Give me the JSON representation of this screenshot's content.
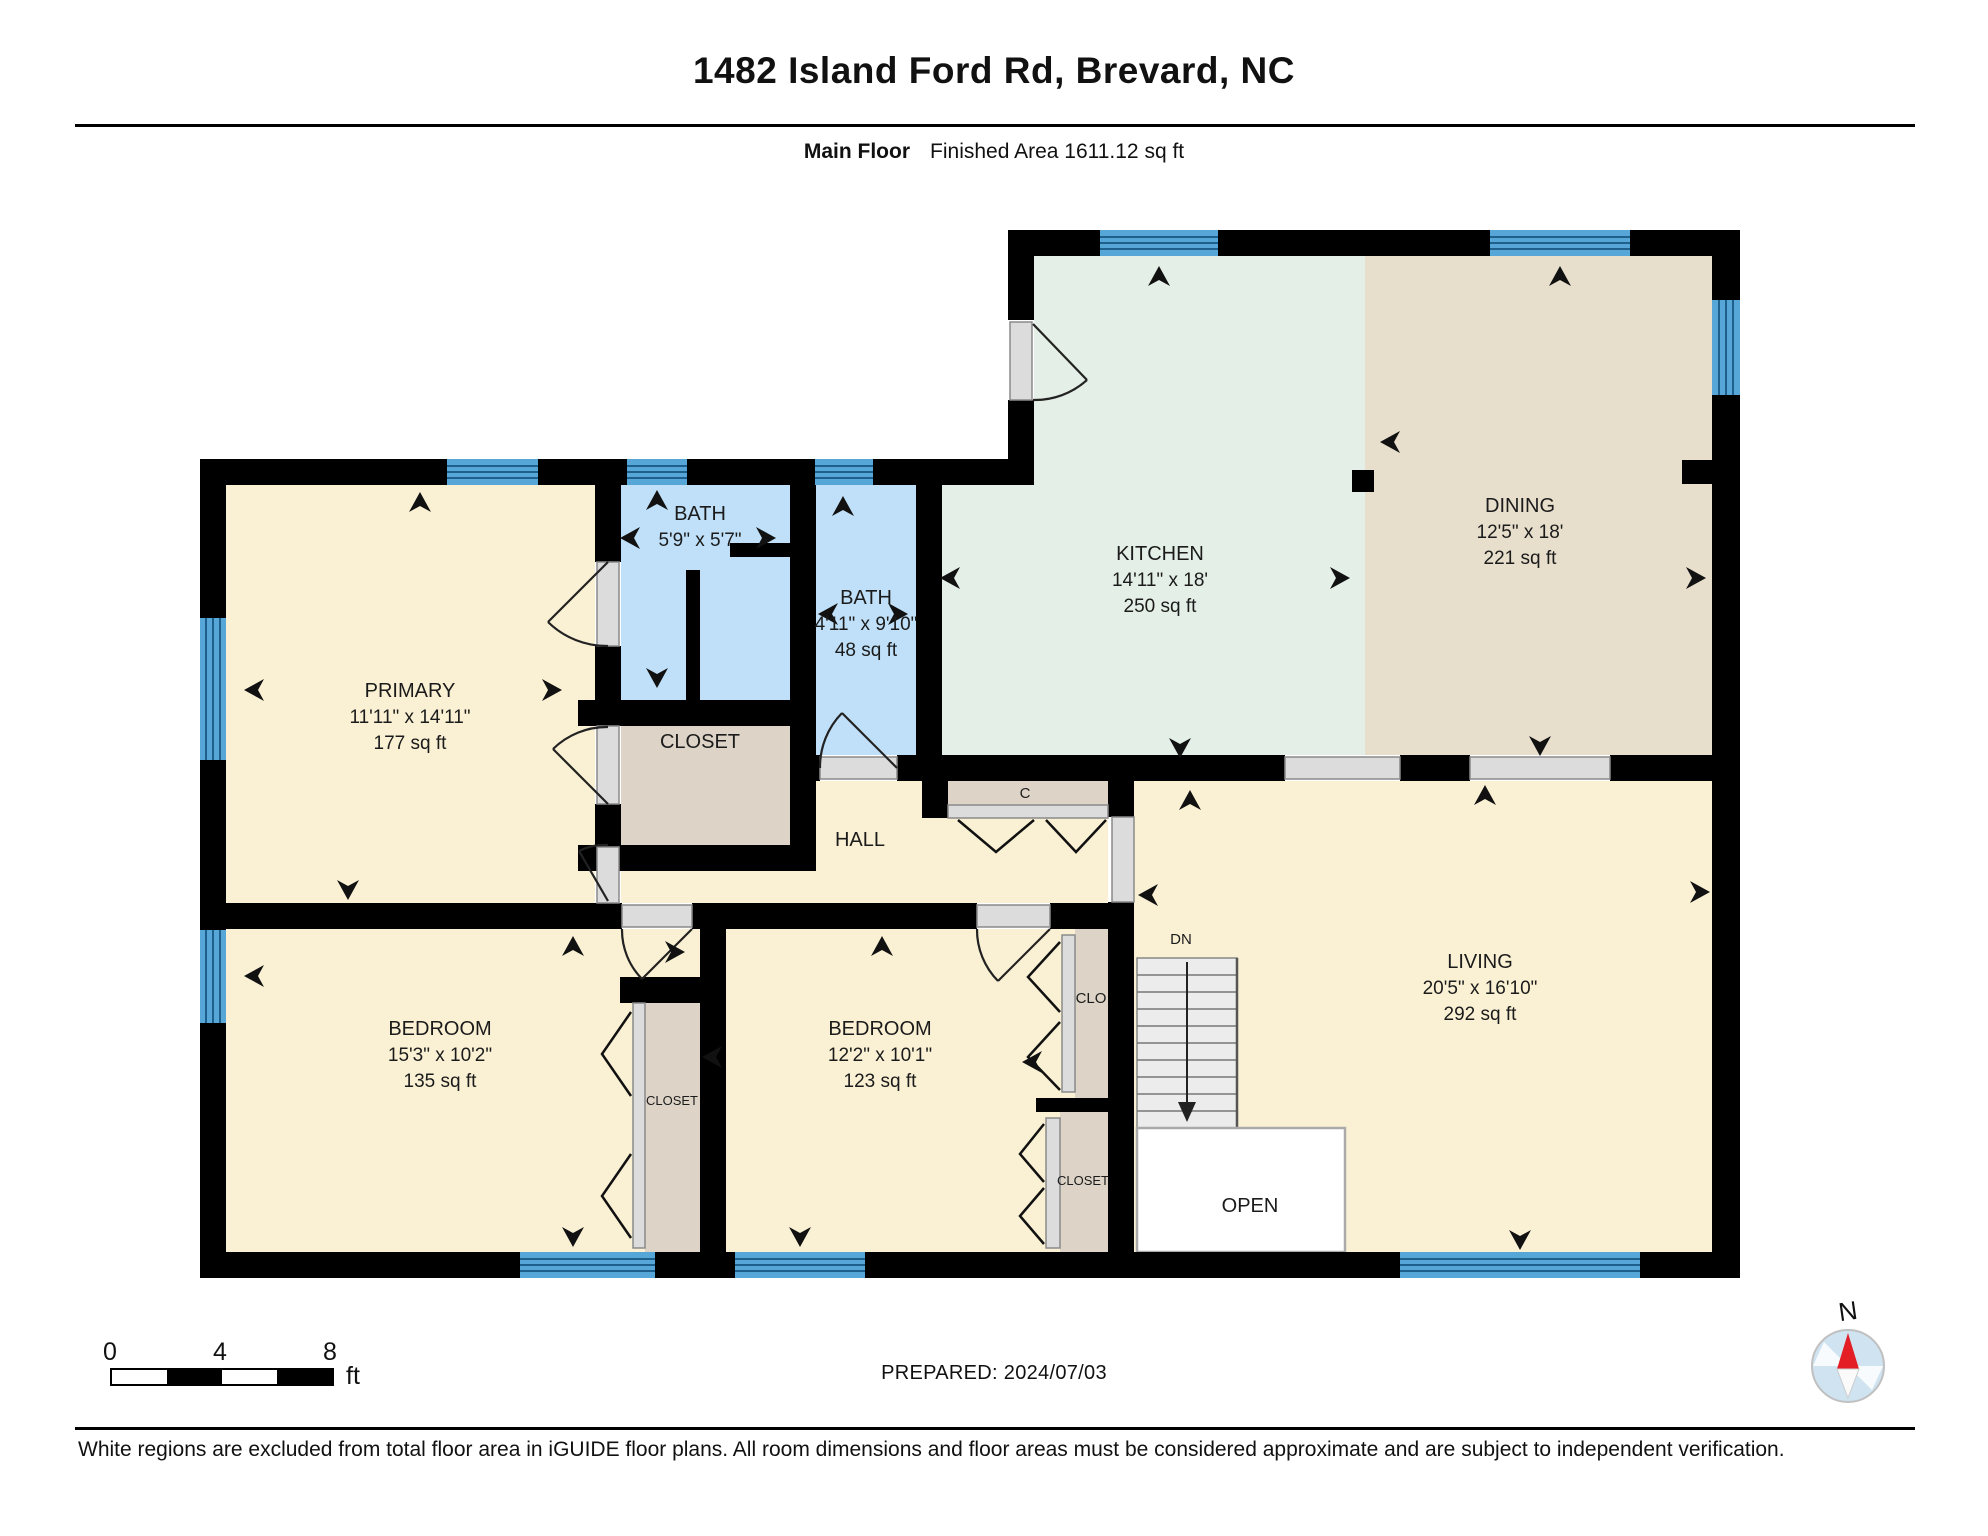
{
  "header": {
    "title": "1482 Island Ford Rd, Brevard, NC",
    "floor_label": "Main Floor",
    "area_label": "Finished Area 1611.12 sq ft"
  },
  "rooms": {
    "primary": {
      "name": "PRIMARY",
      "dims": "11'11\" x 14'11\"",
      "area": "177 sq ft"
    },
    "bath1": {
      "name": "BATH",
      "dims": "5'9\" x 5'7\""
    },
    "bath2": {
      "name": "BATH",
      "dims": "4'11\" x 9'10\"",
      "area": "48 sq ft"
    },
    "kitchen": {
      "name": "KITCHEN",
      "dims": "14'11\" x 18'",
      "area": "250 sq ft"
    },
    "dining": {
      "name": "DINING",
      "dims": "12'5\" x 18'",
      "area": "221 sq ft"
    },
    "living": {
      "name": "LIVING",
      "dims": "20'5\" x 16'10\"",
      "area": "292 sq ft"
    },
    "bedroom1": {
      "name": "BEDROOM",
      "dims": "15'3\" x 10'2\"",
      "area": "135 sq ft"
    },
    "bedroom2": {
      "name": "BEDROOM",
      "dims": "12'2\" x 10'1\"",
      "area": "123 sq ft"
    }
  },
  "labels": {
    "hall": "HALL",
    "c": "C",
    "dn": "DN",
    "open": "OPEN",
    "closet_primary": "CLOSET",
    "closet_bedrooms": "CLOSET",
    "clo": "CLO",
    "closet_bedroom2": "CLOSET"
  },
  "scalebar": {
    "t0": "0",
    "t4": "4",
    "t8": "8",
    "unit": "ft"
  },
  "prepared": {
    "text": "PREPARED: 2024/07/03"
  },
  "compass": {
    "label": "N"
  },
  "footer": {
    "disclaimer": "White regions are excluded from total floor area in iGUIDE floor plans. All room dimensions and floor areas must be considered approximate and are subject to independent verification."
  },
  "colors": {
    "wall": "#000000",
    "window_blue": "#56a7d8",
    "window_stripe": "#1f5f8b",
    "bath_fill": "#bfe0f8",
    "kitchen_fill": "#e4efe7",
    "dining_fill": "#e7decc",
    "room_fill": "#faf1d4",
    "closet_fill": "#ddd4c7",
    "door_gray": "#dcdcdc",
    "stairs_gray": "#ececec",
    "compass_red": "#e31e24",
    "compass_blue": "#cfe3f1"
  }
}
